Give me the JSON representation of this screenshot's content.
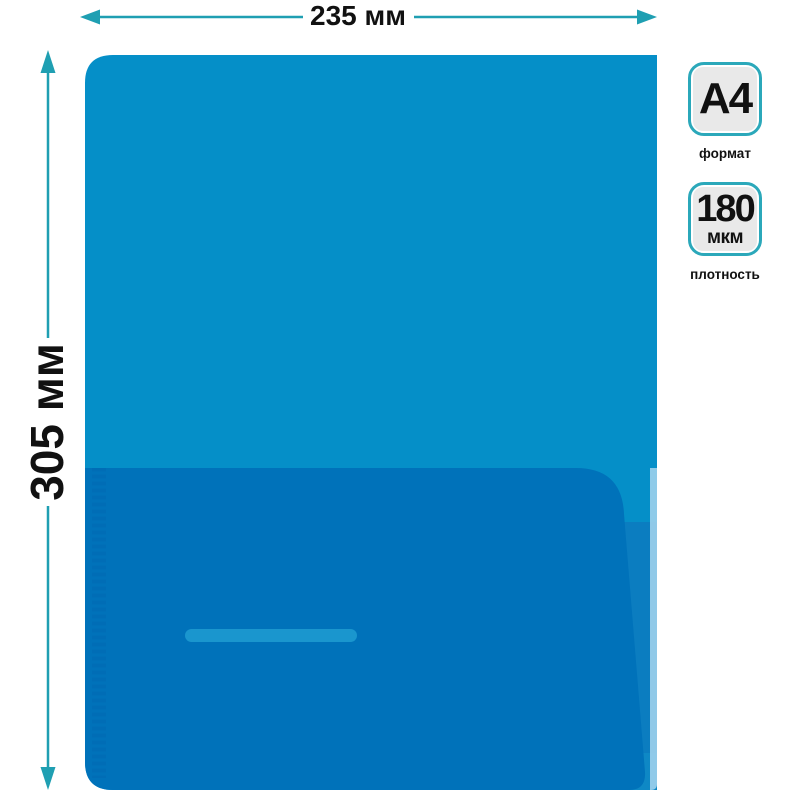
{
  "diagram": {
    "background": "#ffffff",
    "line_color": "#1f9fb2",
    "label_color": "#111111",
    "width_dimension": {
      "label": "235 мм"
    },
    "height_dimension": {
      "label": "305 мм"
    }
  },
  "folder": {
    "body_color": "#058fc8",
    "pocket_color": "#0072ba",
    "pocket_seam_color": "#0069b2",
    "pocket_slot_color": "#1a96ce",
    "back_panel_color": "#0b7dc0",
    "corner_patch_color": "#0e88c5",
    "edge_highlight_color": "#9ed2ec"
  },
  "spec_badges": {
    "border_color": "#2ba8ba",
    "fill_color": "#e9e9e9",
    "text_color": "#111111",
    "items": [
      {
        "value": "A4",
        "caption": "формат"
      },
      {
        "value": "180",
        "unit": "мкм",
        "caption": "плотность"
      }
    ]
  }
}
